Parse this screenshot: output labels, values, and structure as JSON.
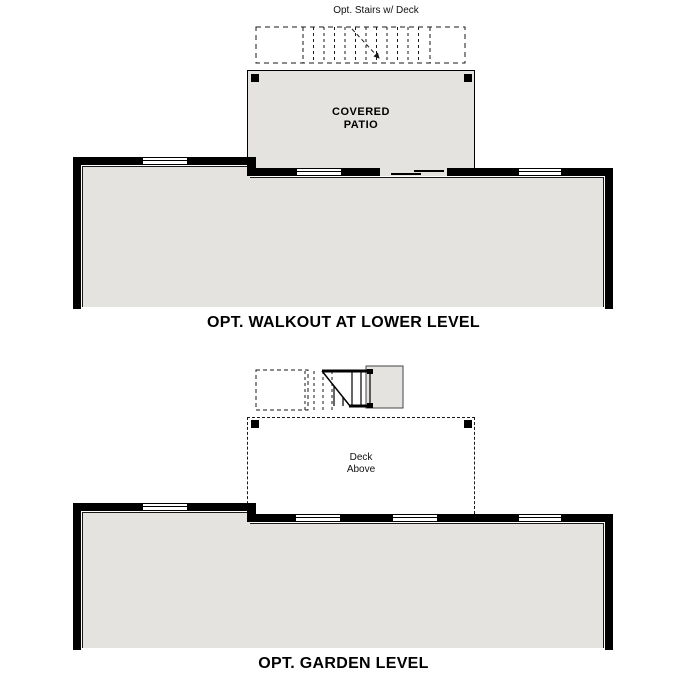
{
  "colors": {
    "floor_fill": "#e4e3e0",
    "wall": "#000000",
    "line_color": "#1a1a1a"
  },
  "walkout_plan": {
    "stairs_label": "Opt. Stairs w/ Deck",
    "patio_label_line1": "COVERED",
    "patio_label_line2": "PATIO",
    "title": "OPT. WALKOUT AT LOWER LEVEL"
  },
  "garden_plan": {
    "deck_label_line1": "Deck",
    "deck_label_line2": "Above",
    "title": "OPT. GARDEN LEVEL"
  }
}
